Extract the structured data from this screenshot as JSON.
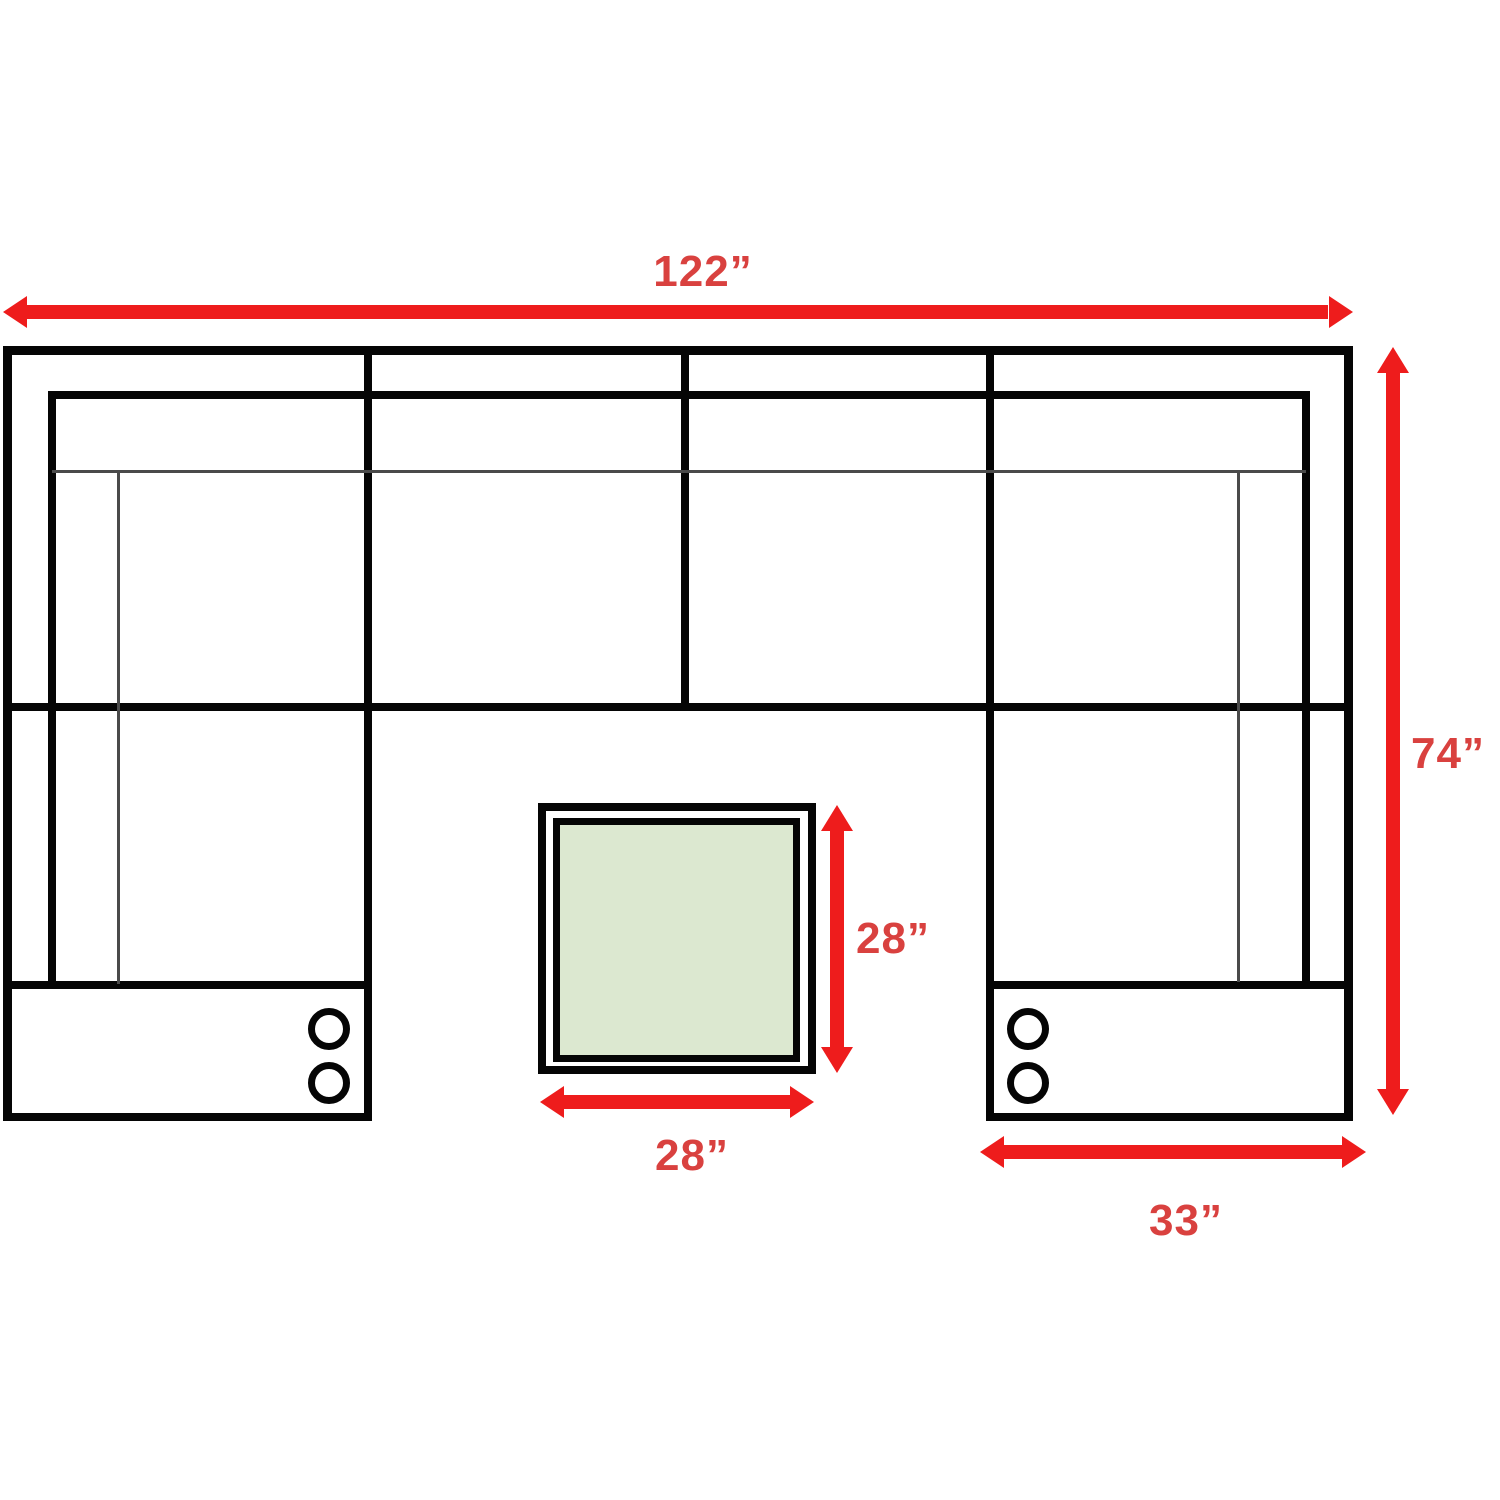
{
  "title": "Sectional sofa with ottoman dimension diagram",
  "canvas": {
    "width": 1500,
    "height": 1500,
    "background": "#ffffff"
  },
  "colors": {
    "outline": "#050505",
    "thin_line": "#4a4a4a",
    "arrow_red": "#ee1c1c",
    "label_red": "#d9413f",
    "ottoman_fill": "#dce8d0"
  },
  "dimension_annotations": [
    {
      "id": "overall_width",
      "label": "122”",
      "orientation": "horizontal"
    },
    {
      "id": "overall_depth",
      "label": "74”",
      "orientation": "vertical"
    },
    {
      "id": "ottoman_depth",
      "label": "28”",
      "orientation": "vertical"
    },
    {
      "id": "ottoman_width",
      "label": "28”",
      "orientation": "horizontal"
    },
    {
      "id": "chaise_width",
      "label": "33”",
      "orientation": "horizontal"
    }
  ]
}
